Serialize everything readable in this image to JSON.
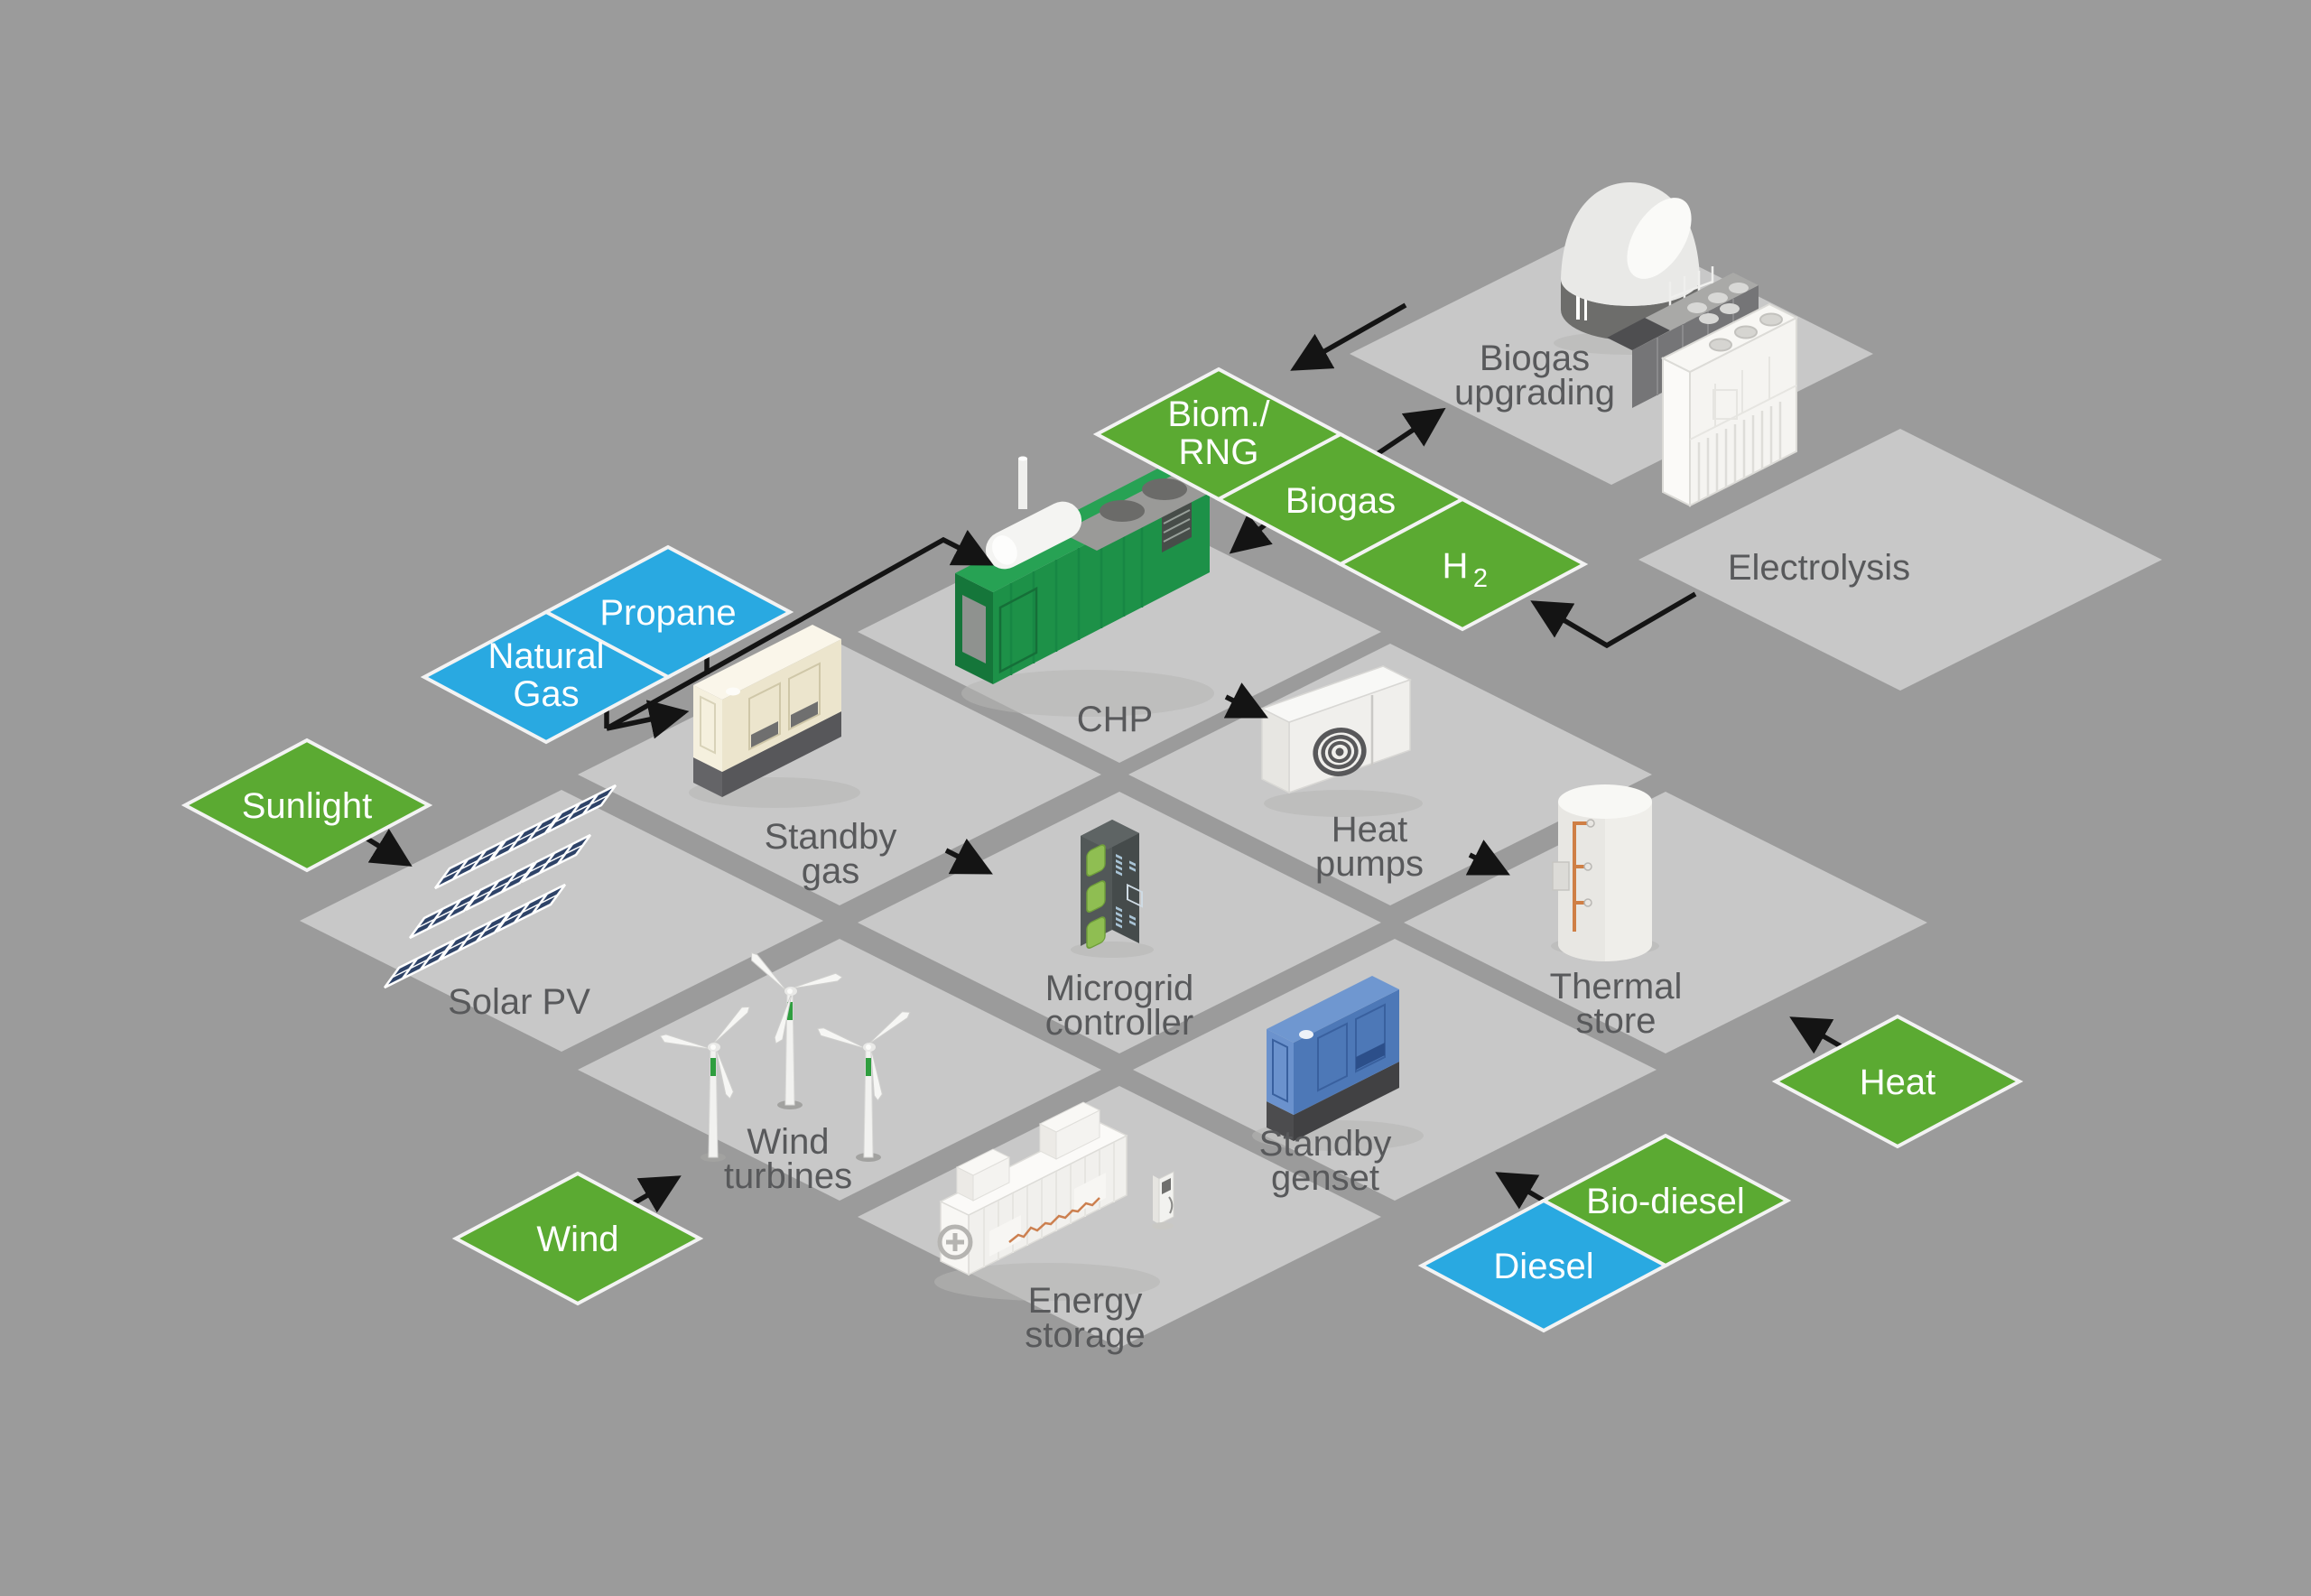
{
  "title": "Microgrid energy system diagram",
  "colors": {
    "background": "#9b9b9b",
    "tile": "#c8c8c8",
    "renewable": "#5baa32",
    "fossil": "#29a9e1",
    "label_text": "#58595b",
    "arrow": "#141414",
    "diamond_border": "#f3f3f3"
  },
  "nodes": {
    "biogas_upgrading": {
      "line1": "Biogas",
      "line2": "upgrading"
    },
    "electrolysis": {
      "line1": "Electrolysis"
    },
    "chp": {
      "line1": "CHP"
    },
    "standby_gas": {
      "line1": "Standby",
      "line2": "gas"
    },
    "heat_pumps": {
      "line1": "Heat",
      "line2": "pumps"
    },
    "solar_pv": {
      "line1": "Solar PV"
    },
    "microgrid_controller": {
      "line1": "Microgrid",
      "line2": "controller"
    },
    "thermal_store": {
      "line1": "Thermal",
      "line2": "store"
    },
    "wind_turbines": {
      "line1": "Wind",
      "line2": "turbines"
    },
    "standby_genset": {
      "line1": "Standby",
      "line2": "genset"
    },
    "energy_storage": {
      "line1": "Energy",
      "line2": "storage"
    }
  },
  "flows": {
    "sunlight": {
      "label": "Sunlight",
      "kind": "renewable"
    },
    "wind": {
      "label": "Wind",
      "kind": "renewable"
    },
    "heat": {
      "label": "Heat",
      "kind": "renewable"
    },
    "biom_rng": {
      "line1": "Biom./",
      "line2": "RNG",
      "kind": "renewable"
    },
    "biogas": {
      "label": "Biogas",
      "kind": "renewable"
    },
    "h2": {
      "base": "H",
      "subscript": "2",
      "kind": "renewable"
    },
    "propane": {
      "label": "Propane",
      "kind": "fossil"
    },
    "natural_gas": {
      "line1": "Natural",
      "line2": "Gas",
      "kind": "fossil"
    },
    "diesel": {
      "label": "Diesel",
      "kind": "fossil"
    },
    "bio_diesel": {
      "label": "Bio-diesel",
      "kind": "renewable"
    }
  },
  "connections": [
    {
      "from": "Sunlight",
      "to": "Solar PV"
    },
    {
      "from": "Wind",
      "to": "Wind turbines"
    },
    {
      "from": "Natural Gas / Propane",
      "to": "CHP"
    },
    {
      "from": "Natural Gas / Propane",
      "to": "Standby gas"
    },
    {
      "from": "Biogas upgrading",
      "to": "Biom./RNG"
    },
    {
      "from": "Biogas",
      "to": "Biogas upgrading"
    },
    {
      "from": "Biom./RNG",
      "to": "CHP"
    },
    {
      "from": "Electrolysis",
      "to": "H2"
    },
    {
      "from": "CHP",
      "to": "Heat pumps"
    },
    {
      "from": "Standby gas",
      "to": "Microgrid controller"
    },
    {
      "from": "Heat pumps",
      "to": "Thermal store"
    },
    {
      "from": "Heat",
      "to": "Thermal store"
    },
    {
      "from": "Diesel / Bio-diesel",
      "to": "Standby genset"
    }
  ]
}
